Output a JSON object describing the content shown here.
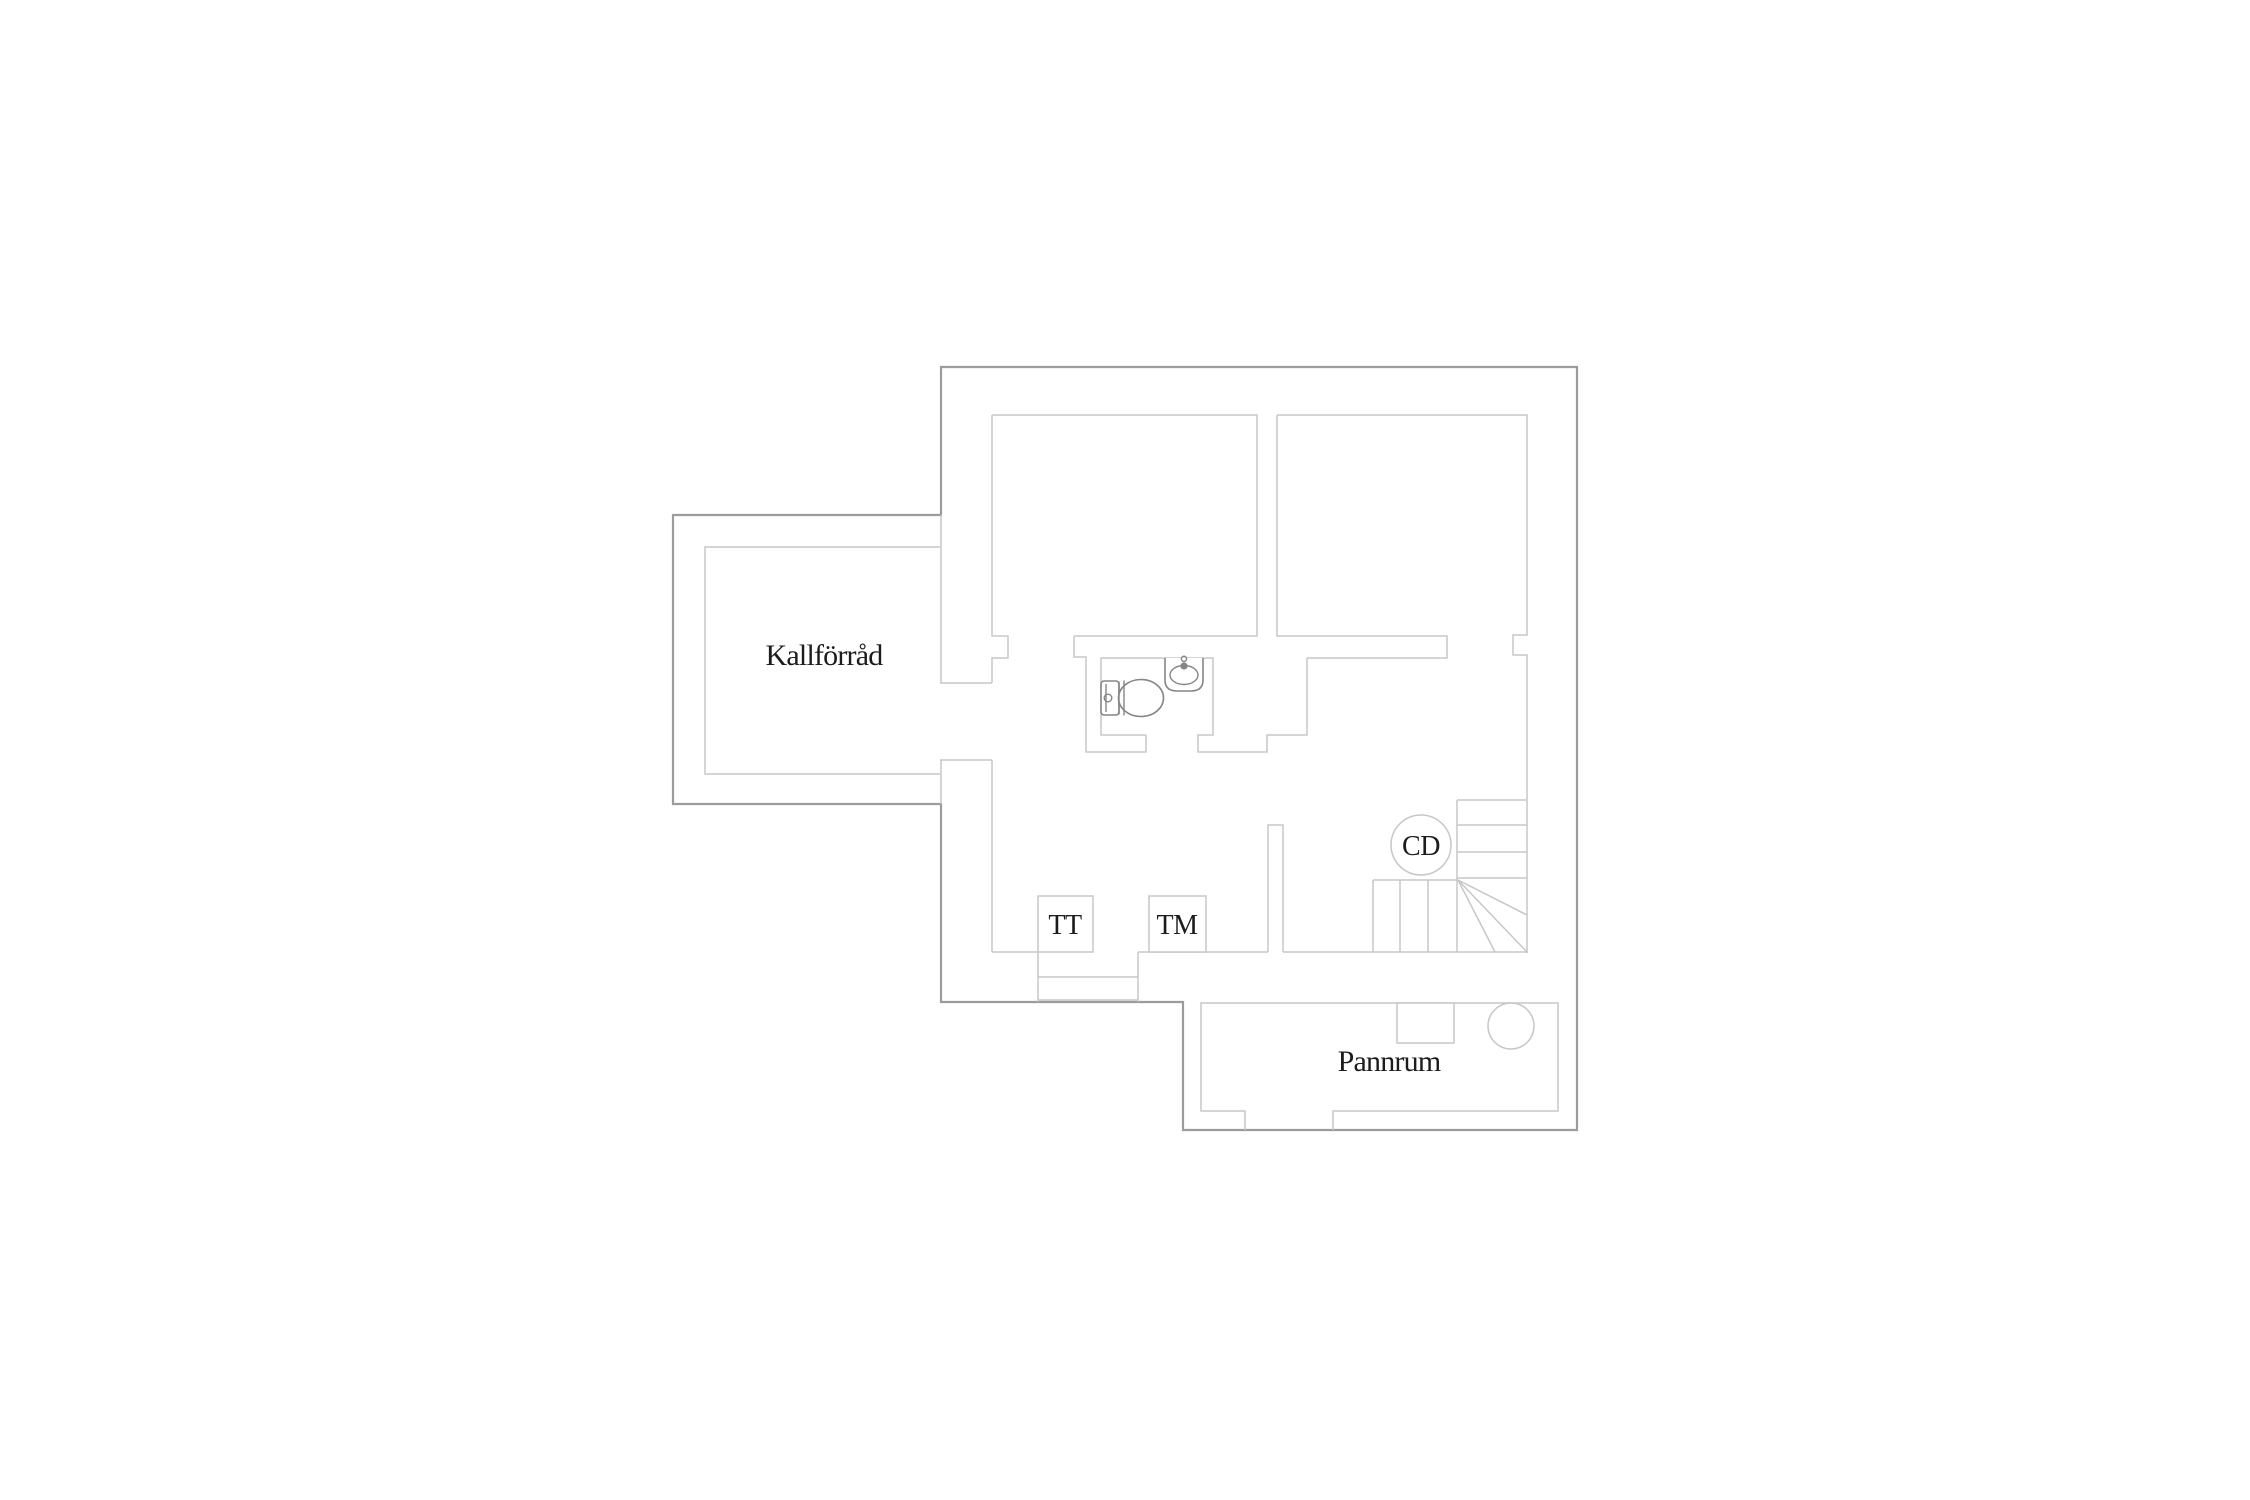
{
  "title": "Basement floor plan",
  "colors": {
    "wall_exterior": "#9c9c9c",
    "wall_interior": "#c7c7c7",
    "fixture": "#858585",
    "label_text": "#1c1c1c",
    "background": "#ffffff"
  },
  "rooms": {
    "kallforrad": {
      "label": "Kallförråd"
    },
    "pannrum": {
      "label": "Pannrum"
    }
  },
  "markers": {
    "tt": {
      "label": "TT"
    },
    "tm": {
      "label": "TM"
    },
    "cd": {
      "label": "CD"
    }
  }
}
